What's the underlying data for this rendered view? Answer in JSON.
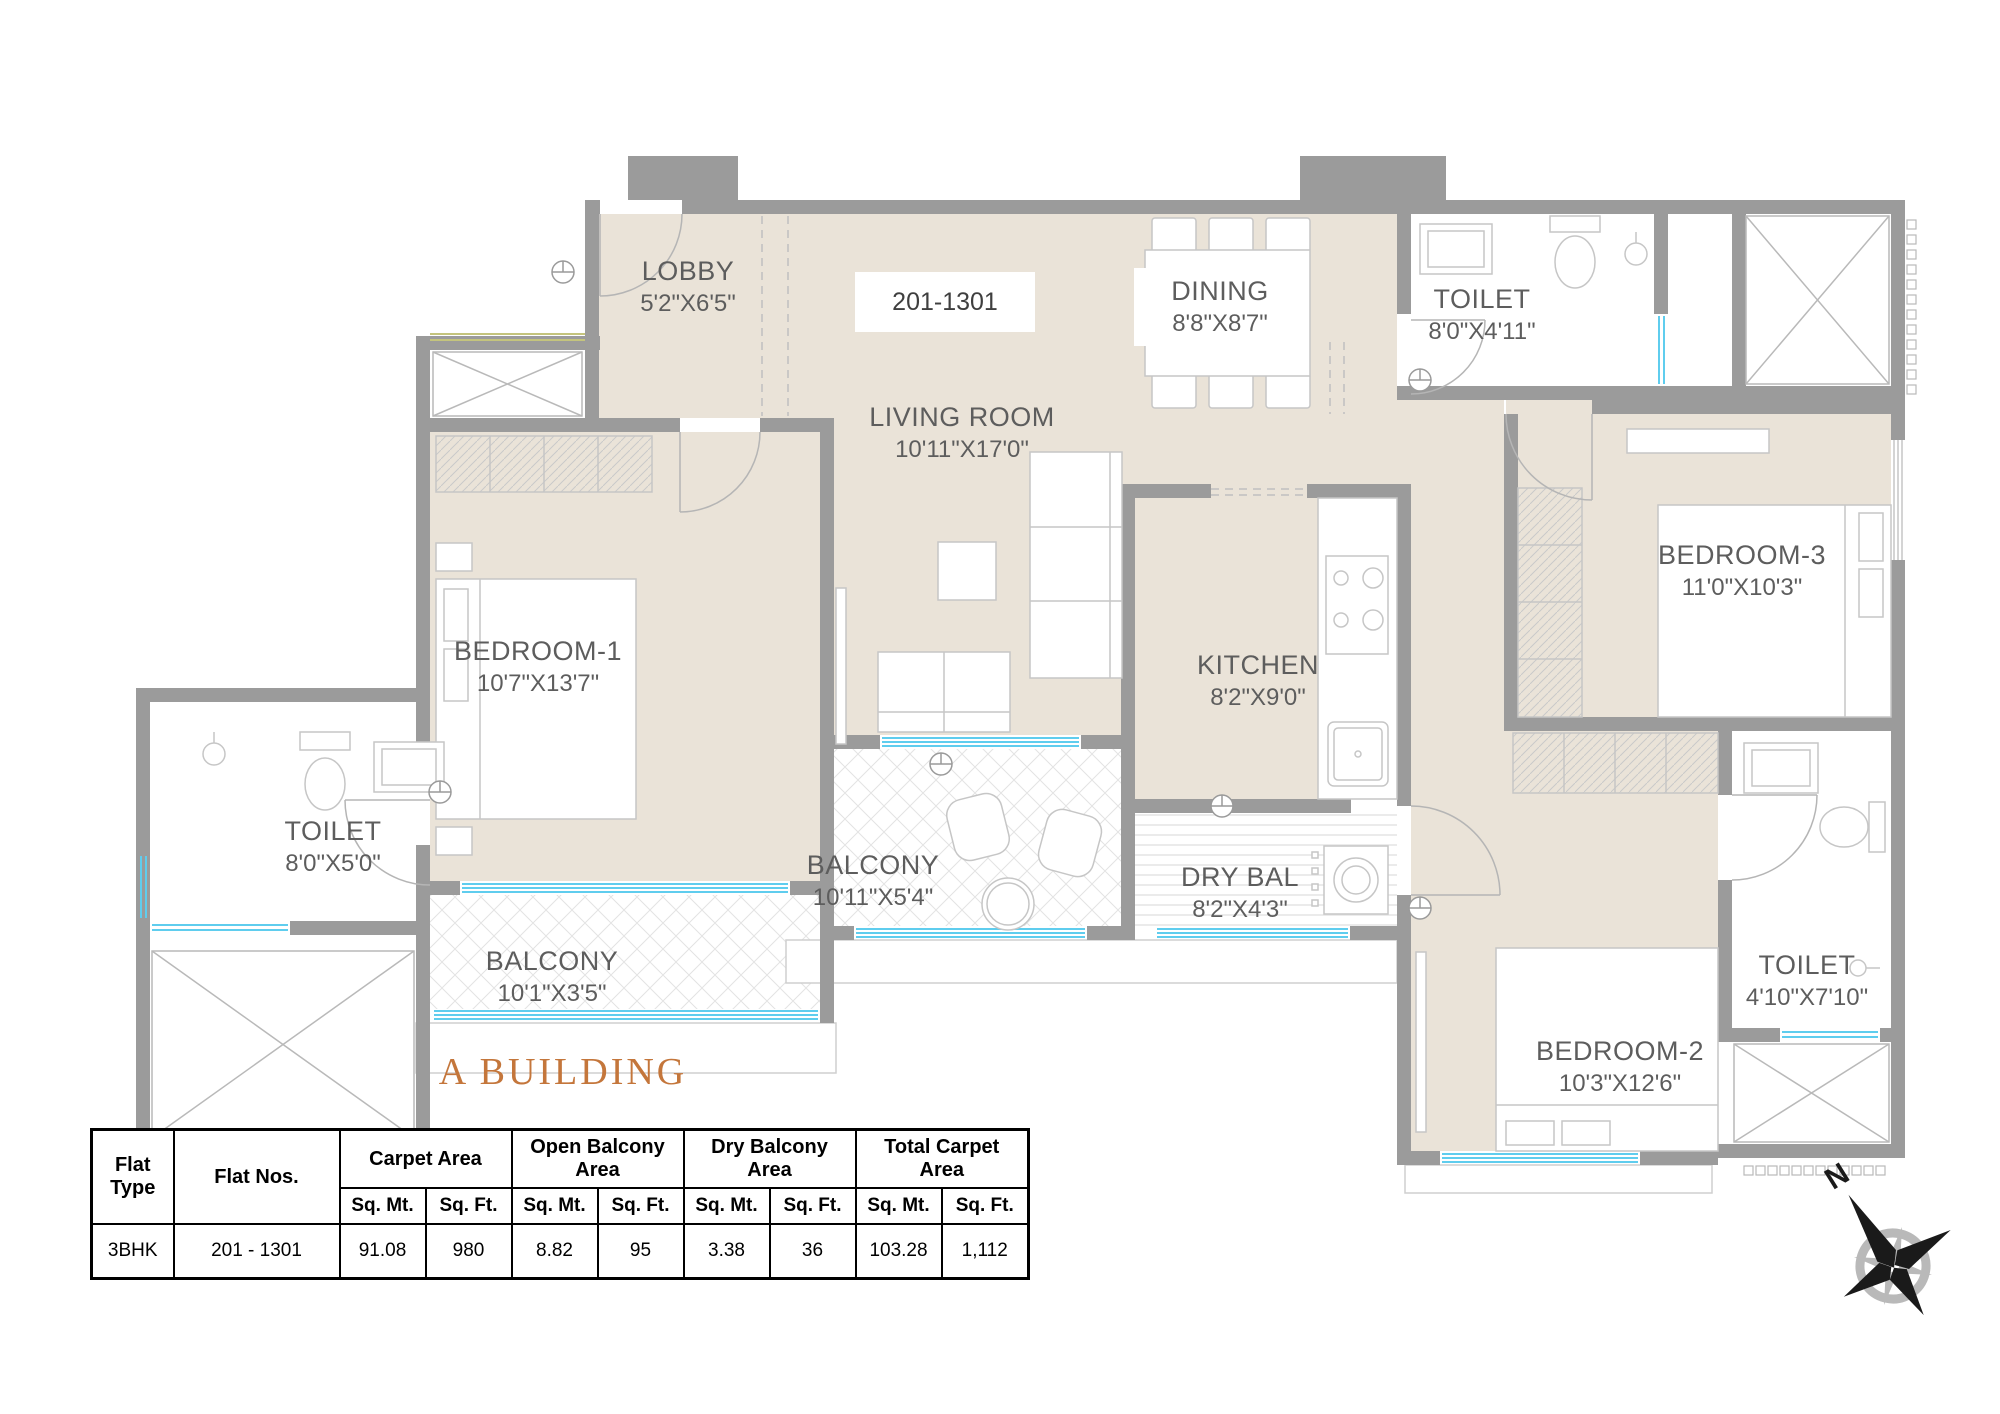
{
  "meta": {
    "unit_label": "201-1301",
    "building_title": "A BUILDING",
    "compass_north_label": "N"
  },
  "rooms": [
    {
      "name": "LOBBY",
      "dims": "5'2\"X6'5\""
    },
    {
      "name": "LIVING ROOM",
      "dims": "10'11\"X17'0\""
    },
    {
      "name": "DINING",
      "dims": "8'8\"X8'7\""
    },
    {
      "name": "TOILET",
      "dims": "8'0\"X4'11\""
    },
    {
      "name": "BEDROOM-3",
      "dims": "11'0\"X10'3\""
    },
    {
      "name": "KITCHEN",
      "dims": "8'2\"X9'0\""
    },
    {
      "name": "BEDROOM-1",
      "dims": "10'7\"X13'7\""
    },
    {
      "name": "TOILET",
      "dims": "8'0\"X5'0\""
    },
    {
      "name": "BALCONY",
      "dims": "10'11\"X5'4\""
    },
    {
      "name": "DRY BAL",
      "dims": "8'2\"X4'3\""
    },
    {
      "name": "BALCONY",
      "dims": "10'1\"X3'5\""
    },
    {
      "name": "BEDROOM-2",
      "dims": "10'3\"X12'6\""
    },
    {
      "name": "TOILET",
      "dims": "4'10\"X7'10\""
    }
  ],
  "area_table": {
    "headers": {
      "flat_type": "Flat Type",
      "flat_nos": "Flat Nos.",
      "carpet": "Carpet Area",
      "open_balcony": "Open Balcony Area",
      "dry_balcony": "Dry Balcony Area",
      "total_carpet": "Total Carpet Area",
      "sq_mt": "Sq. Mt.",
      "sq_ft": "Sq. Ft."
    },
    "row": {
      "flat_type": "3BHK",
      "flat_nos": "201 - 1301",
      "carpet_sq_mt": "91.08",
      "carpet_sq_ft": "980",
      "open_sq_mt": "8.82",
      "open_sq_ft": "95",
      "dry_sq_mt": "3.38",
      "dry_sq_ft": "36",
      "total_sq_mt": "103.28",
      "total_sq_ft": "1,112"
    }
  },
  "colors": {
    "wall": "#9b9b9b",
    "floor": "#eae3d8",
    "window": "#5fcdee",
    "accent": "#c4763b",
    "label_text": "#5d5d5d"
  }
}
